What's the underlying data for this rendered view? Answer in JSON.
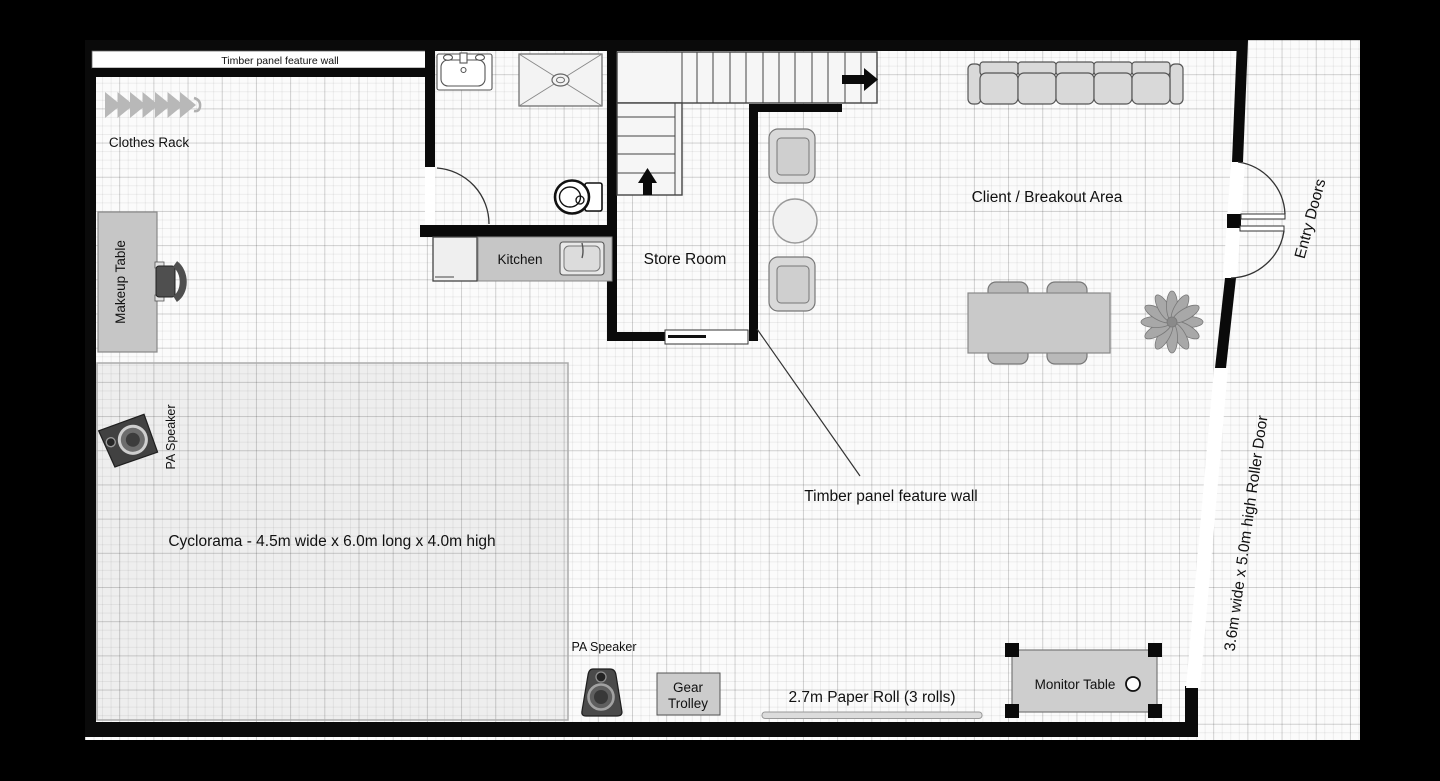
{
  "labels": {
    "feature_wall_top": "Timber panel feature wall",
    "clothes_rack": "Clothes Rack",
    "makeup_table": "Makeup Table",
    "kitchen": "Kitchen",
    "store_room": "Store Room",
    "client_area": "Client / Breakout Area",
    "entry_doors": "Entry Doors",
    "cyclorama": "Cyclorama - 4.5m wide x 6.0m long x 4.0m high",
    "pa_speaker_top": "PA Speaker",
    "pa_speaker_bottom": "PA Speaker",
    "gear_trolley": {
      "line1": "Gear",
      "line2": "Trolley"
    },
    "paper_roll": "2.7m Paper Roll (3 rolls)",
    "monitor_table": "Monitor Table",
    "roller_door": "3.6m wide x 5.0m high Roller Door",
    "feature_wall_annotation": "Timber panel feature wall"
  },
  "colors": {
    "background": "#000000",
    "paper": "#fbfbfb",
    "wall": "#0a0a0a",
    "furniture_fill": "#d6d6d6",
    "counter_fill": "#c6c6c6",
    "text": "#111111"
  }
}
